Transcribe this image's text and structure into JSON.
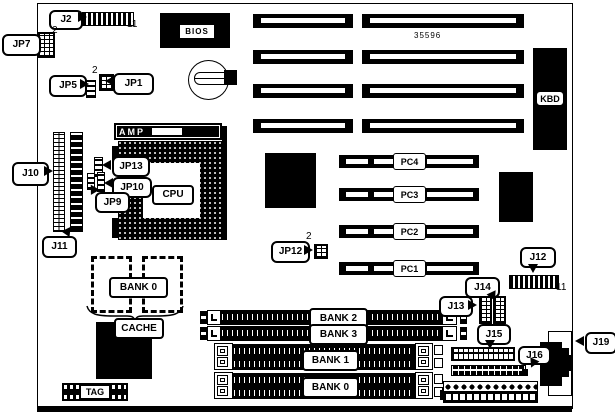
{
  "diagram": {
    "part_number": "35596",
    "components": {
      "bios": "BIOS",
      "kbd": "KBD",
      "amp": "AMP",
      "cpu": "CPU",
      "cache_bank": "BANK 0",
      "cache": "CACHE",
      "tag": "TAG"
    },
    "callouts": {
      "j2": "J2",
      "jp7": "JP7",
      "jp5": "JP5",
      "jp1": "JP1",
      "j10": "J10",
      "j11": "J11",
      "jp13": "JP13",
      "jp10": "JP10",
      "jp9": "JP9",
      "jp12": "JP12",
      "j12": "J12",
      "j13": "J13",
      "j14": "J14",
      "j15": "J15",
      "j16": "J16",
      "j19": "J19"
    },
    "pin_numbers": {
      "j2_pins": "11",
      "jp7_pin2": "2",
      "jp5_jp1_pin2": "2",
      "jp12_pin2": "2",
      "j12_pins": "11"
    },
    "pci_slots": [
      "PC4",
      "PC3",
      "PC2",
      "PC1"
    ],
    "simm_banks": [
      "BANK 2",
      "BANK 3",
      "BANK 1",
      "BANK 0"
    ]
  }
}
